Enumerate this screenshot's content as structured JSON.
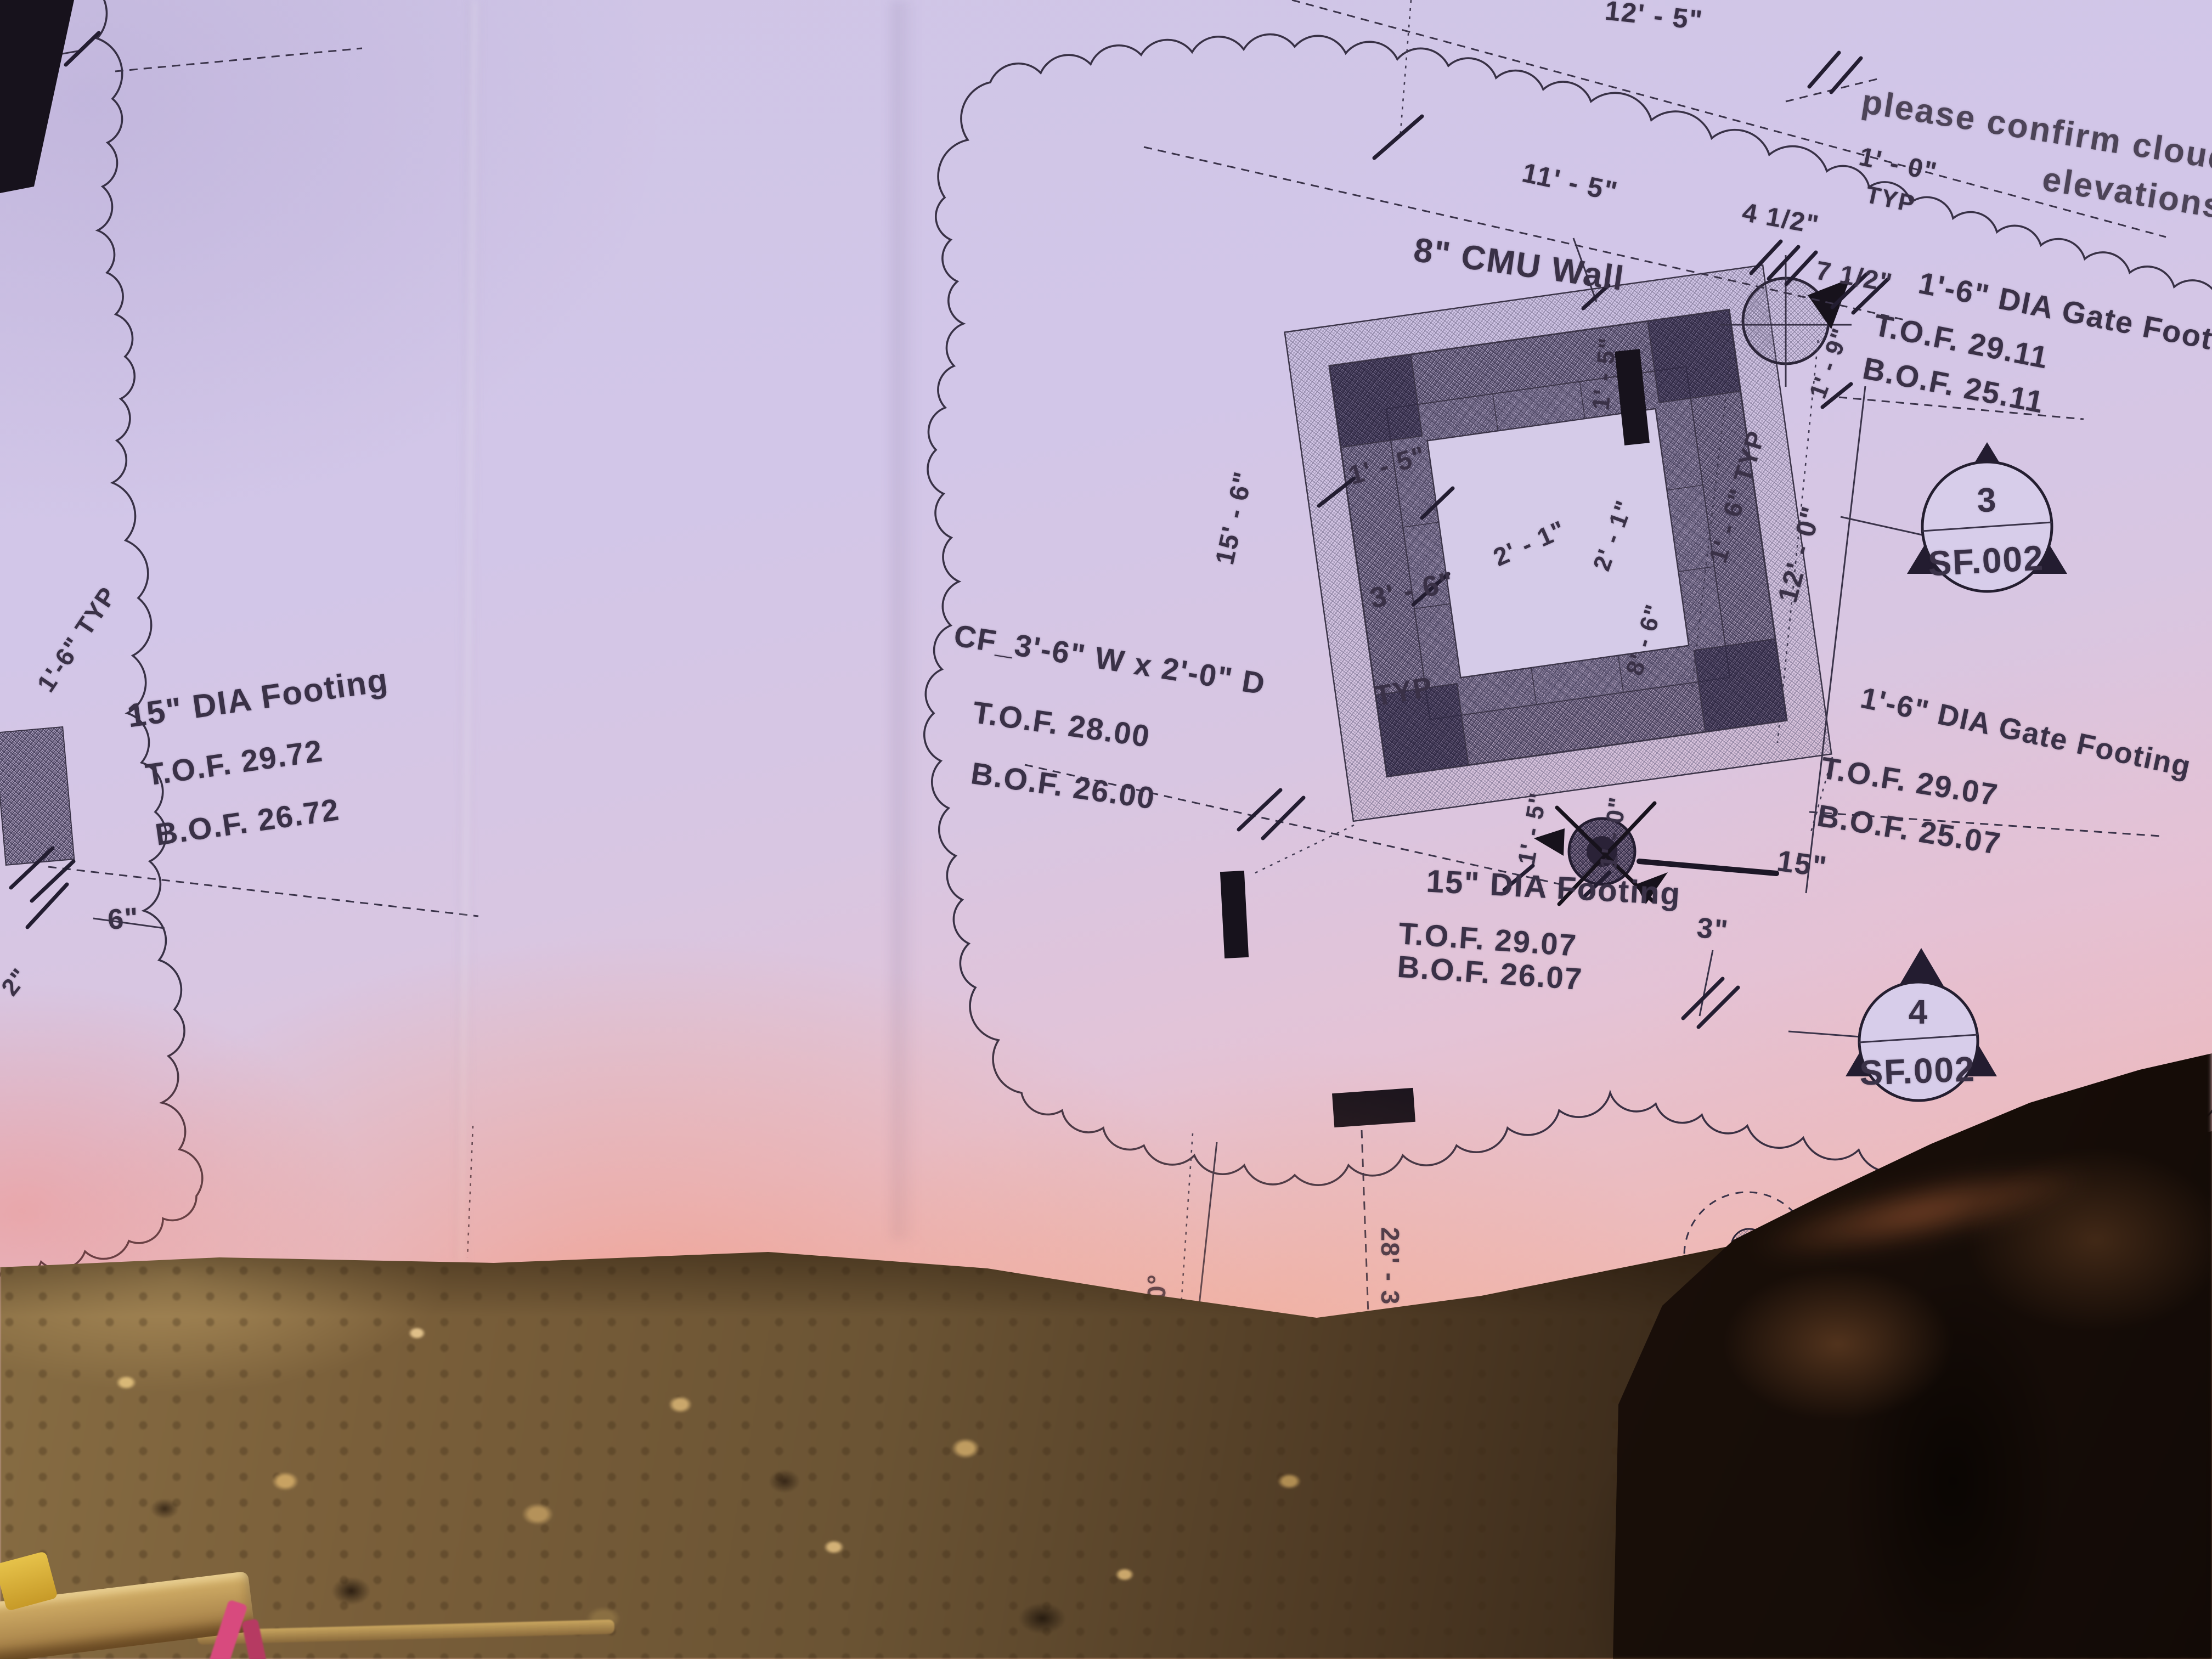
{
  "note": {
    "line1": "please confirm cloud",
    "line2": "elevations"
  },
  "left_detail": {
    "title": "15\" DIA Footing",
    "tof": "T.O.F. 29.72",
    "bof": "B.O.F. 26.72",
    "dim_6in": "6\"",
    "dim_typ": "1'-6\" TYP",
    "dim_2in": "2\""
  },
  "main_detail": {
    "wall_label": "8\" CMU Wall",
    "cf": {
      "label": "CF_3'-6\" W x 2'-0\" D",
      "tof": "T.O.F. 28.00",
      "bof": "B.O.F. 26.00"
    },
    "footing_15": {
      "title": "15\" DIA Footing",
      "tof": "T.O.F. 29.07",
      "bof": "B.O.F. 26.07"
    },
    "gate_footing_right": {
      "title": "1'-6\" DIA Gate Footing",
      "tof": "T.O.F. 29.11",
      "bof": "B.O.F. 25.11"
    },
    "gate_footing_lower": {
      "title": "1'-6\" DIA Gate Footing",
      "tof": "T.O.F. 29.07",
      "bof": "B.O.F. 25.07"
    },
    "markers": [
      {
        "number": "3",
        "sheet": "SF.002"
      },
      {
        "number": "4",
        "sheet": "SF.002"
      }
    ],
    "dims": {
      "top_12_5": "12' - 5\"",
      "top_11_5": "11' - 5\"",
      "top_1_0": "1' - 0\"",
      "top_typ": "TYP",
      "top_4_half": "4 1/2\"",
      "right_7_half": "7 1/2\"",
      "right_1_9": "1' - 9\"",
      "left_1_5": "1' - 5\"",
      "left_3_6": "3' - 6\"",
      "left_typ": "TYP",
      "mid_2_1": "2' - 1\"",
      "vert_2_1": "2' - 1\"",
      "vert_8_6": "8' - 6\"",
      "vert_1_5": "1' - 5\"",
      "left_15_6": "15' - 6\"",
      "right_1_6_typ": "1' - 6\" TYP",
      "right_12_0": "12' - 0\"",
      "bottom_1_5": "1' - 5\"",
      "bottom_1_0": "1' - 0\"",
      "bottom_15": "15\"",
      "bottom_3": "3\"",
      "angle_15": "15.00°",
      "bottom_28_3": "28' - 3"
    }
  }
}
